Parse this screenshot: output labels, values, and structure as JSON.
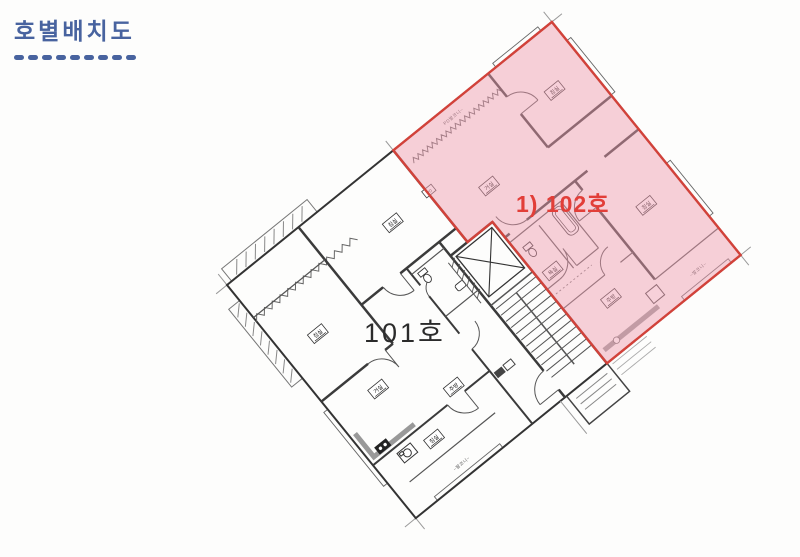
{
  "header": {
    "title": "호별배치도",
    "accent_color": "#48639f",
    "underline_dash_count": 9
  },
  "units": {
    "u101": {
      "label": "101호",
      "label_color": "#2b2b2b"
    },
    "u102": {
      "label": "1) 102호",
      "label_color": "#e23e38",
      "highlight_fill": "#ef9db0",
      "highlight_border": "#d2423a"
    }
  },
  "room_labels": {
    "bedroom": "침실",
    "living": "거실",
    "kitchen": "주방",
    "bath": "욕실",
    "balcony": "~발코니~",
    "pd_balcony": "PD발코니~",
    "pd": "PD"
  }
}
